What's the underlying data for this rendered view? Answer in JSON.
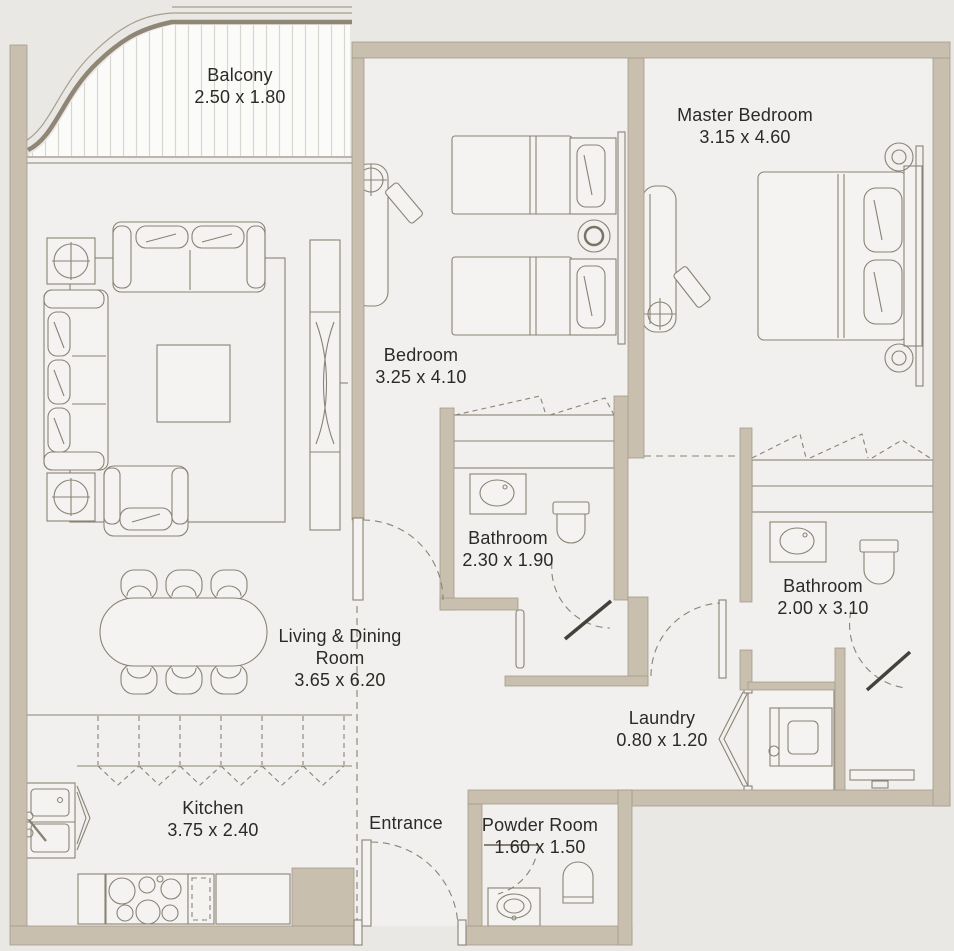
{
  "page": {
    "background": "#eae8e5"
  },
  "colors": {
    "wall": "#c8bfae",
    "floor": "#f1f0ee",
    "line": "#8a8375",
    "text": "#2b2a27",
    "door_leaf": "#44403a",
    "deck_stripe": "#d9d6cf"
  },
  "rooms": {
    "balcony": {
      "name": "Balcony",
      "dims": "2.50 x 1.80"
    },
    "master_bedroom": {
      "name": "Master Bedroom",
      "dims": "3.15 x 4.60"
    },
    "bedroom": {
      "name": "Bedroom",
      "dims": "3.25 x 4.10"
    },
    "bathroom_1": {
      "name": "Bathroom",
      "dims": "2.30 x 1.90"
    },
    "bathroom_2": {
      "name": "Bathroom",
      "dims": "2.00 x 3.10"
    },
    "living_dining": {
      "name": "Living & Dining",
      "name2": "Room",
      "dims": "3.65 x 6.20"
    },
    "laundry": {
      "name": "Laundry",
      "dims": "0.80 x 1.20"
    },
    "kitchen": {
      "name": "Kitchen",
      "dims": "3.75 x 2.40"
    },
    "entrance": {
      "name": "Entrance"
    },
    "powder_room": {
      "name": "Powder Room",
      "dims": "1.60 x 1.50"
    }
  }
}
